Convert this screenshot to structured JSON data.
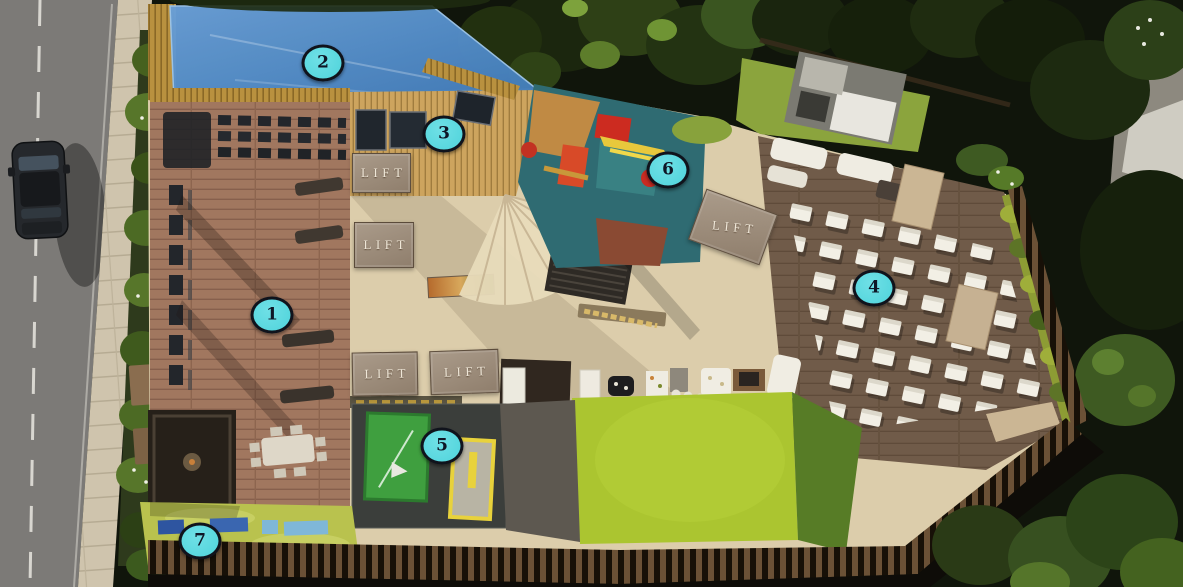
{
  "markers": [
    {
      "number": "1",
      "x": 272,
      "y": 315
    },
    {
      "number": "2",
      "x": 323,
      "y": 63
    },
    {
      "number": "3",
      "x": 444,
      "y": 134
    },
    {
      "number": "4",
      "x": 874,
      "y": 288
    },
    {
      "number": "5",
      "x": 442,
      "y": 446
    },
    {
      "number": "6",
      "x": 668,
      "y": 170
    },
    {
      "number": "7",
      "x": 200,
      "y": 541
    }
  ],
  "lifts": [
    {
      "label": "LIFT",
      "x": 352,
      "y": 153,
      "w": 57,
      "h": 38,
      "rotate": 0,
      "text_rotate": 0
    },
    {
      "label": "LIFT",
      "x": 354,
      "y": 222,
      "w": 58,
      "h": 44,
      "rotate": 0,
      "text_rotate": 0
    },
    {
      "label": "LIFT",
      "x": 352,
      "y": 352,
      "w": 64,
      "h": 42,
      "rotate": -1,
      "text_rotate": 0
    },
    {
      "label": "LIFT",
      "x": 430,
      "y": 350,
      "w": 67,
      "h": 42,
      "rotate": -2,
      "text_rotate": 0
    },
    {
      "label": "LIFT",
      "x": 695,
      "y": 200,
      "w": 74,
      "h": 52,
      "rotate": 20,
      "text_rotate": -14
    }
  ],
  "colors": {
    "marker_fill": "#4FD3DB",
    "marker_border": "#10131C",
    "marker_text": "#0E1626",
    "lift_block": "#8F7E6C",
    "lift_text": "#EFE7D8",
    "pool_blue": "#4E88C6",
    "lawn_green": "#ABC530",
    "playground_teal": "#2F6B72",
    "theatre_deck": "#705B49",
    "gym_deck": "#A1775F"
  }
}
